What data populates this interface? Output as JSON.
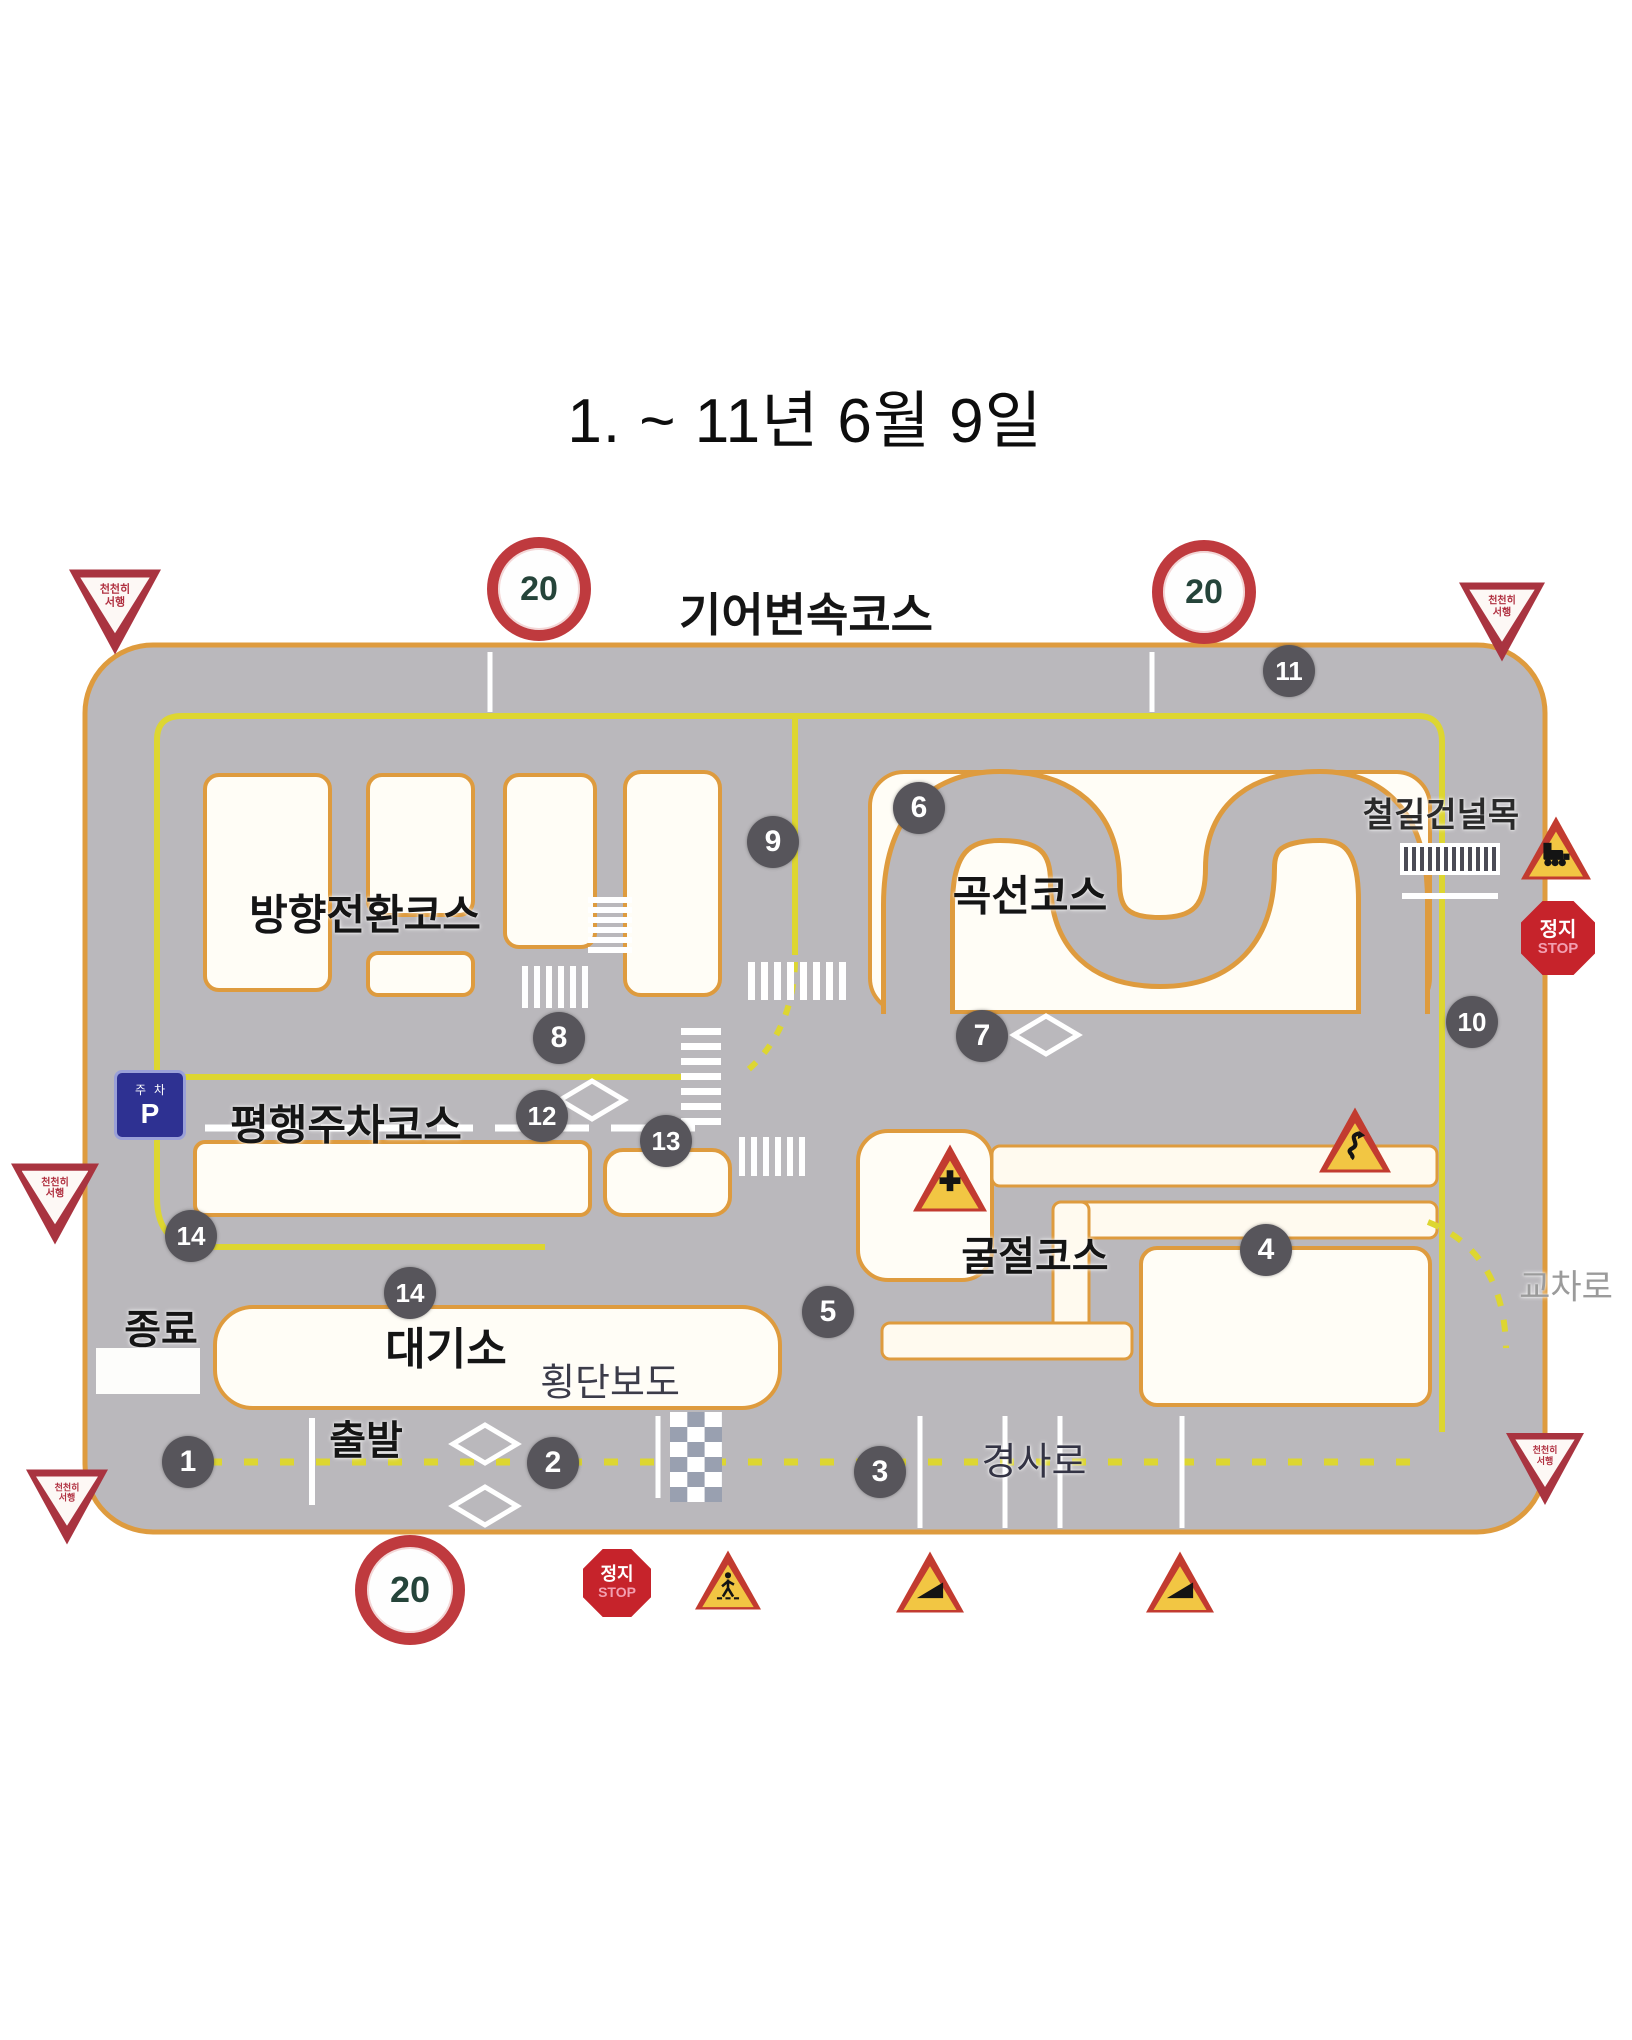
{
  "title": "1. ~ 11년 6월 9일",
  "colors": {
    "road": "#bab8bc",
    "road_border": "#de9b3e",
    "island": "#fffdf6",
    "channel": "#fffaef",
    "yellow_line": "#ddd631",
    "badge_bg": "#57555b",
    "sign_red": "#c23b30",
    "sign_yellow": "#f2c643",
    "stop_red": "#c6232b",
    "parking_blue": "#2e3192"
  },
  "course_labels": [
    {
      "name": "gear-shift-course-label",
      "text": "기어변속코스",
      "x": 806,
      "y": 612,
      "size": 46,
      "weight": "bold",
      "color": "#151515"
    },
    {
      "name": "direction-change-course-label",
      "text": "방향전환코스",
      "x": 365,
      "y": 912,
      "size": 42,
      "weight": "bold",
      "color": "#151515"
    },
    {
      "name": "curve-course-label",
      "text": "곡선코스",
      "x": 1030,
      "y": 893,
      "size": 42,
      "weight": "bold",
      "color": "#151515"
    },
    {
      "name": "parallel-parking-course-label",
      "text": "평행주차코스",
      "x": 346,
      "y": 1122,
      "size": 42,
      "weight": "bold",
      "color": "#151515"
    },
    {
      "name": "articulated-course-label",
      "text": "굴절코스",
      "x": 1035,
      "y": 1253,
      "size": 40,
      "weight": "bold",
      "color": "#151515"
    },
    {
      "name": "waiting-area-label",
      "text": "대기소",
      "x": 446,
      "y": 1345,
      "size": 44,
      "weight": "bold",
      "color": "#151515"
    },
    {
      "name": "crosswalk-label",
      "text": "횡단보도",
      "x": 610,
      "y": 1379,
      "size": 38,
      "weight": "normal",
      "color": "#3c3c49"
    },
    {
      "name": "end-label",
      "text": "종료",
      "x": 161,
      "y": 1326,
      "size": 40,
      "weight": "bold",
      "color": "#151515"
    },
    {
      "name": "start-label",
      "text": "출발",
      "x": 366,
      "y": 1437,
      "size": 40,
      "weight": "bold",
      "color": "#151515"
    },
    {
      "name": "slope-label",
      "text": "경사로",
      "x": 1034,
      "y": 1458,
      "size": 38,
      "weight": "normal",
      "color": "#333344"
    },
    {
      "name": "railroad-crossing-label",
      "text": "철길건널목",
      "x": 1441,
      "y": 812,
      "size": 34,
      "weight": "bold",
      "color": "#2a2a2a"
    },
    {
      "name": "intersection-label",
      "text": "교차로",
      "x": 1566,
      "y": 1284,
      "size": 34,
      "weight": "normal",
      "color": "#9b9b9b"
    }
  ],
  "checkpoints": [
    {
      "n": "1",
      "x": 188,
      "y": 1462
    },
    {
      "n": "2",
      "x": 553,
      "y": 1463
    },
    {
      "n": "3",
      "x": 880,
      "y": 1472
    },
    {
      "n": "4",
      "x": 1266,
      "y": 1250
    },
    {
      "n": "5",
      "x": 828,
      "y": 1312
    },
    {
      "n": "6",
      "x": 919,
      "y": 808
    },
    {
      "n": "7",
      "x": 982,
      "y": 1036
    },
    {
      "n": "8",
      "x": 559,
      "y": 1038
    },
    {
      "n": "9",
      "x": 773,
      "y": 842
    },
    {
      "n": "10",
      "x": 1472,
      "y": 1022
    },
    {
      "n": "11",
      "x": 1289,
      "y": 671
    },
    {
      "n": "12",
      "x": 542,
      "y": 1116
    },
    {
      "n": "13",
      "x": 666,
      "y": 1141
    },
    {
      "n": "14",
      "x": 191,
      "y": 1236
    },
    {
      "n": "14",
      "x": 410,
      "y": 1293
    }
  ],
  "signs": [
    {
      "type": "yield",
      "name": "yield-sign-top-left",
      "x": 115,
      "y": 612,
      "s": 92,
      "lines": [
        "천천히",
        "서행"
      ]
    },
    {
      "type": "speed",
      "name": "speed-limit-20-top-left",
      "x": 539,
      "y": 589,
      "s": 82,
      "value": "20"
    },
    {
      "type": "speed",
      "name": "speed-limit-20-top-right",
      "x": 1204,
      "y": 592,
      "s": 82,
      "value": "20"
    },
    {
      "type": "yield",
      "name": "yield-sign-top-right",
      "x": 1502,
      "y": 622,
      "s": 86,
      "lines": [
        "천천히",
        "서행"
      ]
    },
    {
      "type": "train",
      "name": "railroad-crossing-warning-sign",
      "x": 1556,
      "y": 848,
      "s": 70
    },
    {
      "type": "stop",
      "name": "stop-sign-right",
      "x": 1558,
      "y": 938,
      "s": 74,
      "lines": [
        "정지",
        "STOP"
      ]
    },
    {
      "type": "yield",
      "name": "yield-sign-left-middle",
      "x": 55,
      "y": 1204,
      "s": 88,
      "lines": [
        "천천히",
        "서행"
      ]
    },
    {
      "type": "scurve",
      "name": "double-bend-warning-sign",
      "x": 1355,
      "y": 1140,
      "s": 72
    },
    {
      "type": "cross",
      "name": "crossroads-warning-sign",
      "x": 950,
      "y": 1178,
      "s": 74
    },
    {
      "type": "yield",
      "name": "yield-sign-bottom-right",
      "x": 1545,
      "y": 1469,
      "s": 78,
      "lines": [
        "천천히",
        "서행"
      ]
    },
    {
      "type": "yield",
      "name": "yield-sign-bottom-left",
      "x": 67,
      "y": 1507,
      "s": 82,
      "lines": [
        "천천히",
        "서행"
      ]
    },
    {
      "type": "speed",
      "name": "speed-limit-20-bottom",
      "x": 410,
      "y": 1590,
      "s": 86,
      "value": "20"
    },
    {
      "type": "stop",
      "name": "stop-sign-bottom",
      "x": 617,
      "y": 1583,
      "s": 68,
      "lines": [
        "정지",
        "STOP"
      ]
    },
    {
      "type": "pedestrian",
      "name": "pedestrian-crossing-warning-sign",
      "x": 728,
      "y": 1580,
      "s": 66
    },
    {
      "type": "slope",
      "name": "uphill-slope-warning-sign-1",
      "x": 930,
      "y": 1582,
      "s": 68
    },
    {
      "type": "slope",
      "name": "uphill-slope-warning-sign-2",
      "x": 1180,
      "y": 1582,
      "s": 68
    },
    {
      "type": "parking",
      "name": "parking-sign",
      "x": 150,
      "y": 1105,
      "s": 66,
      "lines": [
        "주차",
        "P"
      ]
    }
  ]
}
